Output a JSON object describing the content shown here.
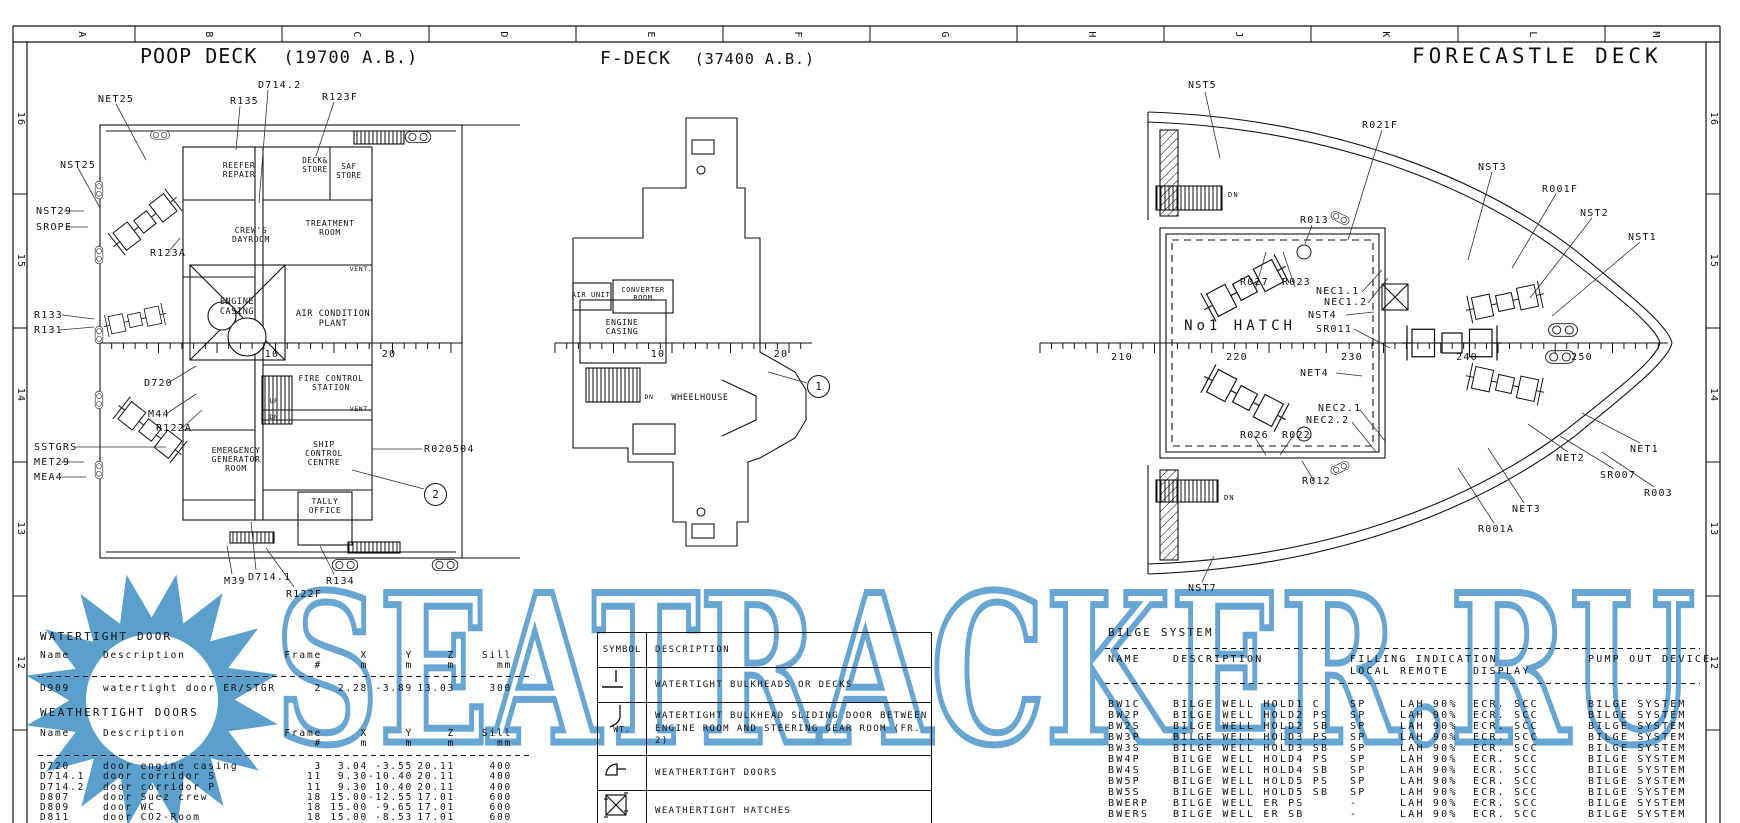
{
  "meta": {
    "watermark": "SEATRACKER.RU",
    "watermark_color": "#5b9fcc"
  },
  "grid": {
    "letters": [
      {
        "t": "A",
        "x": 81,
        "y": 35,
        "c": "rot"
      },
      {
        "t": "B",
        "x": 208,
        "y": 35,
        "c": "rot"
      },
      {
        "t": "C",
        "x": 356,
        "y": 35,
        "c": "rot"
      },
      {
        "t": "D",
        "x": 503,
        "y": 35,
        "c": "rot"
      },
      {
        "t": "E",
        "x": 650,
        "y": 35,
        "c": "rot"
      },
      {
        "t": "F",
        "x": 797,
        "y": 35,
        "c": "rot"
      },
      {
        "t": "G",
        "x": 944,
        "y": 35,
        "c": "rot"
      },
      {
        "t": "H",
        "x": 1091,
        "y": 35,
        "c": "rot"
      },
      {
        "t": "J",
        "x": 1238,
        "y": 35,
        "c": "rot"
      },
      {
        "t": "K",
        "x": 1385,
        "y": 35,
        "c": "rot"
      },
      {
        "t": "L",
        "x": 1532,
        "y": 35,
        "c": "rot"
      },
      {
        "t": "M",
        "x": 1655,
        "y": 35,
        "c": "rot"
      }
    ],
    "numbers": [
      {
        "t": "16",
        "x": 20,
        "y": 119,
        "c": "rot"
      },
      {
        "t": "15",
        "x": 20,
        "y": 261,
        "c": "rot"
      },
      {
        "t": "14",
        "x": 20,
        "y": 395,
        "c": "rot"
      },
      {
        "t": "13",
        "x": 20,
        "y": 529,
        "c": "rot"
      },
      {
        "t": "12",
        "x": 20,
        "y": 663,
        "c": "rot"
      },
      {
        "t": "16",
        "x": 1713,
        "y": 119,
        "c": "rot"
      },
      {
        "t": "15",
        "x": 1713,
        "y": 261,
        "c": "rot"
      },
      {
        "t": "14",
        "x": 1713,
        "y": 395,
        "c": "rot"
      },
      {
        "t": "13",
        "x": 1713,
        "y": 529,
        "c": "rot"
      },
      {
        "t": "12",
        "x": 1713,
        "y": 663,
        "c": "rot"
      }
    ]
  },
  "poop": {
    "title": "POOP DECK",
    "elev": "(19700 A.B.)",
    "labels": [
      {
        "t": "NET25",
        "x": 98,
        "y": 94
      },
      {
        "t": "NST25",
        "x": 60,
        "y": 160
      },
      {
        "t": "NST29",
        "x": 36,
        "y": 206
      },
      {
        "t": "SROPE",
        "x": 36,
        "y": 222
      },
      {
        "t": "R123A",
        "x": 150,
        "y": 248
      },
      {
        "t": "R133",
        "x": 34,
        "y": 310
      },
      {
        "t": "R131",
        "x": 34,
        "y": 325
      },
      {
        "t": "D720",
        "x": 144,
        "y": 378
      },
      {
        "t": "M44",
        "x": 148,
        "y": 409
      },
      {
        "t": "R122A",
        "x": 156,
        "y": 423
      },
      {
        "t": "SSTGRS",
        "x": 34,
        "y": 442
      },
      {
        "t": "MET29",
        "x": 34,
        "y": 457
      },
      {
        "t": "MEA4",
        "x": 34,
        "y": 472
      },
      {
        "t": "R135",
        "x": 230,
        "y": 96
      },
      {
        "t": "D714.2",
        "x": 258,
        "y": 80
      },
      {
        "t": "R123F",
        "x": 322,
        "y": 92
      },
      {
        "t": "R020504",
        "x": 424,
        "y": 444
      },
      {
        "t": "M39",
        "x": 224,
        "y": 576
      },
      {
        "t": "D714.1",
        "x": 248,
        "y": 572
      },
      {
        "t": "R122F",
        "x": 286,
        "y": 589
      },
      {
        "t": "R134",
        "x": 326,
        "y": 576
      }
    ],
    "rooms": [
      {
        "t": "REEFER\nREPAIR",
        "x": 239,
        "y": 161,
        "fs": 8,
        "c": "ctr room"
      },
      {
        "t": "DECK&\nSTORE",
        "x": 315,
        "y": 157,
        "fs": 7.5,
        "c": "ctr room"
      },
      {
        "t": "SAF\nSTORE",
        "x": 349,
        "y": 163,
        "fs": 7.5,
        "c": "ctr room"
      },
      {
        "t": "TREATMENT\nROOM",
        "x": 330,
        "y": 219,
        "fs": 8,
        "c": "ctr room"
      },
      {
        "t": "CREW'S\nDAYROOM",
        "x": 251,
        "y": 226,
        "fs": 8,
        "c": "ctr room"
      },
      {
        "t": "ENGINE\nCASING",
        "x": 237,
        "y": 298,
        "fs": 8.5,
        "c": "ctr room"
      },
      {
        "t": "AIR CONDITION\nPLANT",
        "x": 333,
        "y": 310,
        "fs": 8.5,
        "c": "ctr room"
      },
      {
        "t": "FIRE CONTROL\nSTATION",
        "x": 331,
        "y": 374,
        "fs": 8,
        "c": "ctr room"
      },
      {
        "t": "SHIP\nCONTROL\nCENTRE",
        "x": 324,
        "y": 440,
        "fs": 8,
        "c": "ctr room"
      },
      {
        "t": "EMERGENCY\nGENERATOR\nROOM",
        "x": 236,
        "y": 446,
        "fs": 8,
        "c": "ctr room"
      },
      {
        "t": "TALLY\nOFFICE",
        "x": 325,
        "y": 497,
        "fs": 8,
        "c": "ctr room"
      },
      {
        "t": "VENT.",
        "x": 361,
        "y": 266,
        "fs": 6.5,
        "c": "ctr room"
      },
      {
        "t": "VENT.",
        "x": 361,
        "y": 406,
        "fs": 6.5,
        "c": "ctr room"
      },
      {
        "t": "UP",
        "x": 274,
        "y": 398,
        "fs": 6.5,
        "c": "ctr room"
      },
      {
        "t": "DN",
        "x": 274,
        "y": 414,
        "fs": 6.5,
        "c": "ctr room"
      }
    ],
    "callout": "2"
  },
  "fdeck": {
    "title": "F-DECK",
    "elev": "(37400 A.B.)",
    "rooms": [
      {
        "t": "AIR UNIT",
        "x": 591,
        "y": 291,
        "fs": 7,
        "c": "ctr room"
      },
      {
        "t": "CONVERTER\nROOM",
        "x": 643,
        "y": 286,
        "fs": 7,
        "c": "ctr room"
      },
      {
        "t": "ENGINE\nCASING",
        "x": 622,
        "y": 318,
        "fs": 8,
        "c": "ctr room"
      },
      {
        "t": "WHEELHOUSE",
        "x": 700,
        "y": 394,
        "fs": 8.5,
        "c": "ctr room"
      },
      {
        "t": "DN",
        "x": 649,
        "y": 394,
        "fs": 6.5,
        "c": "ctr room"
      }
    ],
    "callout": "1"
  },
  "fore": {
    "title": "FORECASTLE DECK",
    "labels": [
      {
        "t": "NST5",
        "x": 1188,
        "y": 80
      },
      {
        "t": "R021F",
        "x": 1362,
        "y": 120
      },
      {
        "t": "NST3",
        "x": 1478,
        "y": 162
      },
      {
        "t": "R001F",
        "x": 1542,
        "y": 184
      },
      {
        "t": "NST2",
        "x": 1580,
        "y": 208
      },
      {
        "t": "NST1",
        "x": 1628,
        "y": 232
      },
      {
        "t": "R013",
        "x": 1300,
        "y": 215
      },
      {
        "t": "R027",
        "x": 1240,
        "y": 277
      },
      {
        "t": "R023",
        "x": 1282,
        "y": 277
      },
      {
        "t": "NEC1.1",
        "x": 1316,
        "y": 286
      },
      {
        "t": "NEC1.2",
        "x": 1324,
        "y": 297
      },
      {
        "t": "NST4",
        "x": 1308,
        "y": 310
      },
      {
        "t": "SR011",
        "x": 1316,
        "y": 324
      },
      {
        "t": "NET4",
        "x": 1300,
        "y": 368
      },
      {
        "t": "NEC2.1",
        "x": 1318,
        "y": 403
      },
      {
        "t": "NEC2.2",
        "x": 1306,
        "y": 415
      },
      {
        "t": "R026",
        "x": 1240,
        "y": 430
      },
      {
        "t": "R022",
        "x": 1282,
        "y": 430
      },
      {
        "t": "R012",
        "x": 1302,
        "y": 476
      },
      {
        "t": "NST7",
        "x": 1188,
        "y": 583
      },
      {
        "t": "R001A",
        "x": 1478,
        "y": 524
      },
      {
        "t": "NET3",
        "x": 1512,
        "y": 504
      },
      {
        "t": "NET2",
        "x": 1556,
        "y": 453
      },
      {
        "t": "NET1",
        "x": 1630,
        "y": 444
      },
      {
        "t": "SR007",
        "x": 1600,
        "y": 470
      },
      {
        "t": "R003",
        "x": 1644,
        "y": 488
      },
      {
        "t": "No1 HATCH",
        "x": 1240,
        "y": 318,
        "c": "ctr hatchlbl"
      },
      {
        "t": "DN",
        "x": 1228,
        "y": 191,
        "fs": 7
      },
      {
        "t": "DN",
        "x": 1224,
        "y": 494,
        "fs": 7
      }
    ]
  },
  "rulernums": [
    {
      "t": "10",
      "x": 272,
      "y": 349,
      "c": "ctr"
    },
    {
      "t": "20",
      "x": 389,
      "y": 349,
      "c": "ctr"
    },
    {
      "t": "10",
      "x": 658,
      "y": 349,
      "c": "ctr"
    },
    {
      "t": "20",
      "x": 781,
      "y": 349,
      "c": "ctr"
    },
    {
      "t": "210",
      "x": 1122,
      "y": 352,
      "c": "ctr"
    },
    {
      "t": "220",
      "x": 1237,
      "y": 352,
      "c": "ctr"
    },
    {
      "t": "230",
      "x": 1352,
      "y": 352,
      "c": "ctr"
    },
    {
      "t": "240",
      "x": 1467,
      "y": 352,
      "c": "ctr"
    },
    {
      "t": "250",
      "x": 1582,
      "y": 352,
      "c": "ctr"
    }
  ],
  "wt_table": {
    "title": "WATERTIGHT DOOR",
    "head1": [
      "Name",
      "Description",
      "Frame",
      "X",
      "Y",
      "Z",
      "Sill"
    ],
    "head2": [
      "",
      "",
      "#",
      "m",
      "m",
      "m",
      "mm"
    ],
    "rows": [
      [
        "D909",
        "watertight door ER/STGR",
        "2",
        "2.28",
        "-3.89",
        "13.03",
        "300"
      ]
    ]
  },
  "wx_table": {
    "title": "WEATHERTIGHT DOORS",
    "head1": [
      "Name",
      "Description",
      "Frame",
      "X",
      "Y",
      "Z",
      "Sill"
    ],
    "head2": [
      "",
      "",
      "#",
      "m",
      "m",
      "m",
      "mm"
    ],
    "rows": [
      [
        "D720",
        "door engine casing",
        "3",
        "3.04",
        "-3.55",
        "20.11",
        "400"
      ],
      [
        "D714.1",
        "door corridor S",
        "11",
        "9.30",
        "-10.40",
        "20.11",
        "400"
      ],
      [
        "D714.2",
        "door corridor P",
        "11",
        "9.30",
        "10.40",
        "20.11",
        "400"
      ],
      [
        "D807",
        "door Suez crew",
        "18",
        "15.00",
        "-12.55",
        "17.01",
        "600"
      ],
      [
        "D809",
        "door WC",
        "18",
        "15.00",
        "-9.65",
        "17.01",
        "600"
      ],
      [
        "D811",
        "door CO2-Room",
        "18",
        "15.00",
        "-8.53",
        "17.01",
        "600"
      ]
    ]
  },
  "symbols": {
    "col1": "SYMBOL",
    "col2": "DESCRIPTION",
    "rows": [
      {
        "desc": "WATERTIGHT BULKHEADS OR DECKS"
      },
      {
        "wt": "WT.",
        "desc": "WATERTIGHT BULKHEAD SLIDING DOOR BETWEEN ENGINE ROOM AND STEERING GEAR ROOM (FR. 2)"
      },
      {
        "desc": "WEATHERTIGHT DOORS"
      },
      {
        "desc": "WEATHERTIGHT HATCHES"
      }
    ]
  },
  "bilge": {
    "title": "BILGE SYSTEM",
    "h_name": "NAME",
    "h_desc": "DESCRIPTION",
    "h_fill": "FILLING INDICATION",
    "h_local": "LOCAL",
    "h_remote": "REMOTE",
    "h_display": "DISPLAY",
    "h_pump": "PUMP OUT DEVICE",
    "rows": [
      [
        "BW1C",
        "BILGE WELL HOLD1 C",
        "SP",
        "LAH 90%",
        "ECR. SCC",
        "BILGE SYSTEM"
      ],
      [
        "BW2P",
        "BILGE WELL HOLD2 PS",
        "SP",
        "LAH 90%",
        "ECR. SCC",
        "BILGE SYSTEM"
      ],
      [
        "BW2S",
        "BILGE WELL HOLD2 SB",
        "SP",
        "LAH 90%",
        "ECR. SCC",
        "BILGE SYSTEM"
      ],
      [
        "BW3P",
        "BILGE WELL HOLD3 PS",
        "SP",
        "LAH 90%",
        "ECR. SCC",
        "BILGE SYSTEM"
      ],
      [
        "BW3S",
        "BILGE WELL HOLD3 SB",
        "SP",
        "LAH 90%",
        "ECR. SCC",
        "BILGE SYSTEM"
      ],
      [
        "BW4P",
        "BILGE WELL HOLD4 PS",
        "SP",
        "LAH 90%",
        "ECR. SCC",
        "BILGE SYSTEM"
      ],
      [
        "BW4S",
        "BILGE WELL HOLD4 SB",
        "SP",
        "LAH 90%",
        "ECR. SCC",
        "BILGE SYSTEM"
      ],
      [
        "BW5P",
        "BILGE WELL HOLD5 PS",
        "SP",
        "LAH 90%",
        "ECR. SCC",
        "BILGE SYSTEM"
      ],
      [
        "BW5S",
        "BILGE WELL HOLD5 SB",
        "SP",
        "LAH 90%",
        "ECR. SCC",
        "BILGE SYSTEM"
      ],
      [
        "BWERP",
        "BILGE WELL ER PS",
        "-",
        "LAH 90%",
        "ECR. SCC",
        "BILGE SYSTEM"
      ],
      [
        "BWERS",
        "BILGE WELL ER SB",
        "-",
        "LAH 90%",
        "ECR. SCC",
        "BILGE SYSTEM"
      ]
    ]
  }
}
